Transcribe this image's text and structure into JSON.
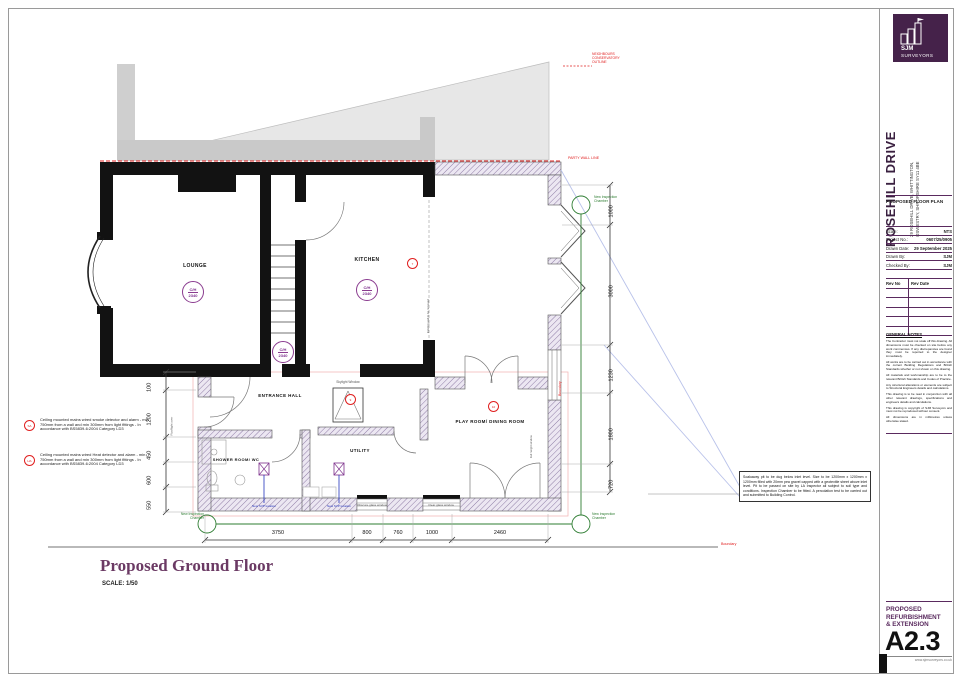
{
  "sheet": {
    "logo": {
      "name": "SJM",
      "subname": "SURVEYORS"
    },
    "project": {
      "title": "ROSEHILL DRIVE",
      "address1": "29 ROSEHILL DRIVE, WHITTINGTON,",
      "address2": "OSWESTRY, SHROPSHIRE SY11 4BE",
      "drawing_type": "PROPOSED FLOOR PLAN"
    },
    "info": {
      "scale_label": "Scale:",
      "scale": "NTS",
      "project_no_label": "Project No.:",
      "project_no": "0607/25/0905",
      "drawn_date_label": "Drawn Date:",
      "drawn_date": "29 September 2025",
      "drawn_by_label": "Drawn By:",
      "drawn_by": "SJM",
      "checked_by_label": "Checked By:",
      "checked_by": "SJM"
    },
    "rev": {
      "col_no": "Rev No",
      "col_date": "Rev Date"
    },
    "notes_title": "GENERAL NOTES",
    "notes": [
      "The Contractor must not scale off this drawing. All dimensions must be checked on site before any work commences. If any discrepancies are found they must be reported to the designer immediately.",
      "All works are to be carried out in accordance with the current Building Regulations and British Standards whether or not shown on this drawing.",
      "All materials and workmanship are to be to the relevant British Standards and Codes of Practice.",
      "Any structural alterations or elements are subject to Structural Engineers details and calculations.",
      "This drawing is to be read in conjunction with all other relevant drawings, specifications and engineers details and calculations.",
      "This drawing is copyright of SJM Surveyors and must not be reproduced without consent.",
      "All dimensions are in millimetres unless otherwise stated."
    ],
    "footer": {
      "drawing_title": "PROPOSED REFURBISHMENT & EXTENSION",
      "sheet_no": "A2.3",
      "website": "www.sjmsurveyors.co.uk"
    }
  },
  "plan": {
    "title": "Proposed Ground Floor",
    "scale": "SCALE: 1/50",
    "rooms": {
      "lounge": "LOUNGE",
      "kitchen": "KITCHEN",
      "hall": "ENTRANCE HALL",
      "shower": "SHOWER ROOM/ WC",
      "utility": "UTILITY",
      "playroom": "PLAY ROOM/ DINING ROOM"
    },
    "ch": {
      "label": "C/H",
      "lounge": "2340",
      "kitchen": "2340",
      "hall": "2340"
    },
    "refs": {
      "smoke": "SA",
      "heat": "HA",
      "kitchen": "7",
      "hall": "9",
      "playroom": "10"
    },
    "labels": {
      "neighbours": "NEIGHBOURS CONSERVATORY OUTLINE",
      "party_wall": "PARTY WALL LINE",
      "boundary": "Boundary",
      "skylight": "Skylight Window",
      "obscure": "Obscure glass window",
      "clear": "Clear glass window",
      "rooflight": "Rooflight over",
      "removed": "Existing wall to be removed",
      "glazing": "Full height window",
      "svp": "New SVP location",
      "chamber": "New Inspection Chamber"
    },
    "notes": {
      "smoke": "Ceiling mounted mains wired smoke detector and alarm - min 750mm from a wall and min 300mm from light fittings - In accordance with BS5839-6:2004 Category LD3",
      "heat": "Ceiling mounted mains wired Heat detector and alarm - min 750mm from a wall and min 300mm from light fittings - In accordance with BS5839-6:2004 Category LD3",
      "soakaway": "Soakaway pit to be dug below inlet level. Size to be 1200mm x 1200mm x 1200mm filled with 20mm pea gravel capped with a geotextile sheet above inlet level. Pit to be passed on site by LA Inspector all subject to soil type and conditions. Inspection Chamber to be fitted. A percolation test to be carried out and submitted to Building Control."
    },
    "dims": {
      "bottom": [
        "3750",
        "800",
        "760",
        "1000",
        "2460"
      ],
      "left": [
        "100",
        "1200",
        "450",
        "600",
        "550"
      ],
      "right": [
        "1000",
        "3000",
        "1230",
        "1800",
        "720"
      ]
    }
  },
  "colors": {
    "brand_purple": "#45224a",
    "title_purple": "#6b3a64",
    "annotation_red": "#e02020",
    "drain_green": "#2e7d32",
    "pipe_blue": "#2233bb"
  }
}
